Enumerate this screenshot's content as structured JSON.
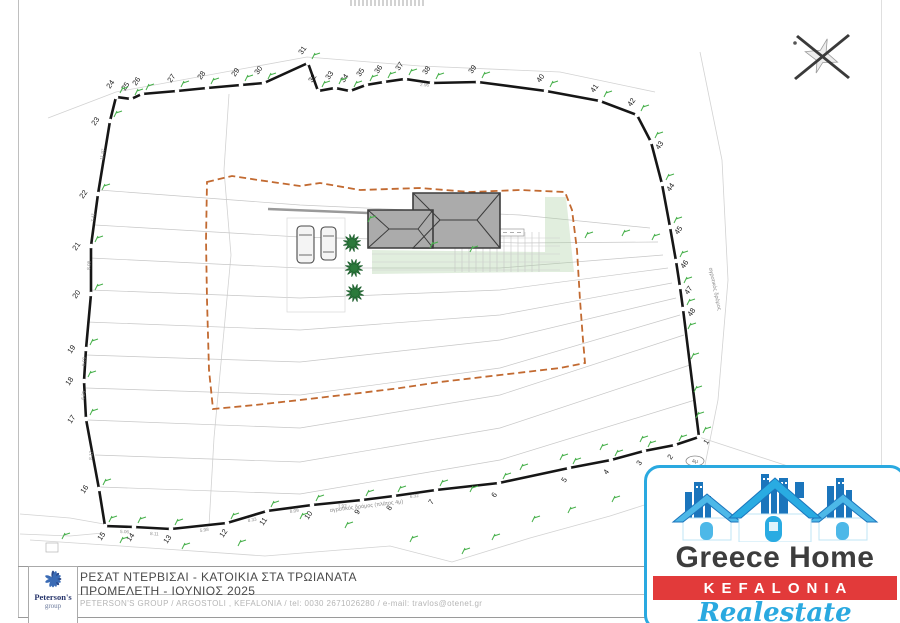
{
  "sheet": {
    "title_line1": "ΡΕΣΑΤ ΝΤΕΡΒΙΣΑΙ -  ΚΑΤΟΙΚΙΑ ΣΤΑ ΤΡΩΙΑΝΑΤΑ",
    "title_line2": "ΠΡΟΜΕΛΕΤΗ - ΙΟΥΝΙΟΣ  2025",
    "contact_line": "PETERSON'S GROUP / ARGOSTOLI , KEFALONIA / tel: 0030 2671026280 / e-mail: travlos@otenet.gr",
    "diagram_fragment": "ΔΙΑΓΡΑΜΜΑ"
  },
  "peterson_logo": {
    "name": "Peterson's",
    "sub": "group"
  },
  "greece_home_logo": {
    "line1": "Greece Home",
    "line2": "KEFALONIA",
    "line3": "Realestate",
    "accent_blue": "#2aa9e0",
    "band_red": "#e23a3a",
    "text_dark": "#3d3d3d"
  },
  "plan": {
    "colors": {
      "boundary": "#161616",
      "marker_green": "#47b04b",
      "setback_orange": "#c26a31",
      "roof_gray": "#ababab",
      "tree_green": "#2b7a3b",
      "contour_gray": "#c7c7c7"
    },
    "road_label_bottom": "αγροτικός δρόμος (πλάτος 4μ)",
    "road_label_right": "αγροτικός δρόμος",
    "oval_label": "4μ",
    "vertices": [
      {
        "n": "23",
        "x": 110,
        "y": 121,
        "side": "left"
      },
      {
        "n": "24",
        "x": 116,
        "y": 97,
        "side": "top"
      },
      {
        "n": "25",
        "x": 131,
        "y": 99,
        "side": "top"
      },
      {
        "n": "26",
        "x": 142,
        "y": 94,
        "side": "top"
      },
      {
        "n": "27",
        "x": 177,
        "y": 91,
        "side": "top"
      },
      {
        "n": "28",
        "x": 207,
        "y": 88,
        "side": "top"
      },
      {
        "n": "29",
        "x": 241,
        "y": 85,
        "side": "top"
      },
      {
        "n": "30",
        "x": 264,
        "y": 83,
        "side": "top"
      },
      {
        "n": "31",
        "x": 308,
        "y": 63,
        "side": "top"
      },
      {
        "n": "32",
        "x": 318,
        "y": 91,
        "side": "top"
      },
      {
        "n": "33",
        "x": 335,
        "y": 88,
        "side": "top"
      },
      {
        "n": "34",
        "x": 350,
        "y": 91,
        "side": "top"
      },
      {
        "n": "35",
        "x": 366,
        "y": 85,
        "side": "top"
      },
      {
        "n": "36",
        "x": 384,
        "y": 82,
        "side": "top"
      },
      {
        "n": "37",
        "x": 405,
        "y": 79,
        "side": "top"
      },
      {
        "n": "38",
        "x": 432,
        "y": 83,
        "side": "top"
      },
      {
        "n": "39",
        "x": 478,
        "y": 82,
        "side": "top"
      },
      {
        "n": "40",
        "x": 546,
        "y": 91,
        "side": "top"
      },
      {
        "n": "41",
        "x": 600,
        "y": 101,
        "side": "top"
      },
      {
        "n": "42",
        "x": 637,
        "y": 115,
        "side": "top"
      },
      {
        "n": "43",
        "x": 651,
        "y": 142,
        "side": "right"
      },
      {
        "n": "44",
        "x": 662,
        "y": 184,
        "side": "right"
      },
      {
        "n": "45",
        "x": 670,
        "y": 227,
        "side": "right"
      },
      {
        "n": "46",
        "x": 676,
        "y": 261,
        "side": "right"
      },
      {
        "n": "47",
        "x": 680,
        "y": 287,
        "side": "right"
      },
      {
        "n": "48",
        "x": 683,
        "y": 309,
        "side": "right"
      },
      {
        "n": "1",
        "x": 699,
        "y": 437,
        "side": "right"
      },
      {
        "n": "2",
        "x": 675,
        "y": 445,
        "side": "bottom"
      },
      {
        "n": "3",
        "x": 644,
        "y": 451,
        "side": "bottom"
      },
      {
        "n": "4",
        "x": 611,
        "y": 460,
        "side": "bottom"
      },
      {
        "n": "5",
        "x": 569,
        "y": 468,
        "side": "bottom"
      },
      {
        "n": "6",
        "x": 499,
        "y": 483,
        "side": "bottom"
      },
      {
        "n": "7",
        "x": 436,
        "y": 490,
        "side": "bottom"
      },
      {
        "n": "8",
        "x": 394,
        "y": 496,
        "side": "bottom"
      },
      {
        "n": "9",
        "x": 362,
        "y": 500,
        "side": "bottom"
      },
      {
        "n": "10",
        "x": 312,
        "y": 505,
        "side": "bottom"
      },
      {
        "n": "11",
        "x": 267,
        "y": 511,
        "side": "bottom"
      },
      {
        "n": "12",
        "x": 227,
        "y": 523,
        "side": "bottom"
      },
      {
        "n": "13",
        "x": 171,
        "y": 529,
        "side": "bottom"
      },
      {
        "n": "14",
        "x": 134,
        "y": 527,
        "side": "bottom"
      },
      {
        "n": "15",
        "x": 105,
        "y": 526,
        "side": "bottom"
      },
      {
        "n": "16",
        "x": 99,
        "y": 489,
        "side": "left"
      },
      {
        "n": "17",
        "x": 86,
        "y": 419,
        "side": "left"
      },
      {
        "n": "18",
        "x": 84,
        "y": 381,
        "side": "left"
      },
      {
        "n": "19",
        "x": 86,
        "y": 349,
        "side": "left"
      },
      {
        "n": "20",
        "x": 91,
        "y": 294,
        "side": "left"
      },
      {
        "n": "21",
        "x": 91,
        "y": 246,
        "side": "left"
      },
      {
        "n": "22",
        "x": 98,
        "y": 194,
        "side": "left"
      }
    ],
    "contours": [
      [
        [
          99,
          190
        ],
        [
          300,
          205
        ],
        [
          520,
          215
        ],
        [
          650,
          228
        ]
      ],
      [
        [
          95,
          225
        ],
        [
          300,
          237
        ],
        [
          520,
          243
        ],
        [
          658,
          242
        ]
      ],
      [
        [
          90,
          258
        ],
        [
          300,
          268
        ],
        [
          500,
          268
        ],
        [
          663,
          255
        ]
      ],
      [
        [
          90,
          290
        ],
        [
          300,
          298
        ],
        [
          500,
          290
        ],
        [
          668,
          268
        ]
      ],
      [
        [
          87,
          322
        ],
        [
          300,
          330
        ],
        [
          500,
          315
        ],
        [
          672,
          283
        ]
      ],
      [
        [
          86,
          355
        ],
        [
          300,
          362
        ],
        [
          500,
          340
        ],
        [
          676,
          298
        ]
      ],
      [
        [
          86,
          388
        ],
        [
          300,
          395
        ],
        [
          500,
          368
        ],
        [
          680,
          315
        ]
      ],
      [
        [
          88,
          420
        ],
        [
          300,
          428
        ],
        [
          500,
          395
        ],
        [
          684,
          335
        ]
      ],
      [
        [
          95,
          455
        ],
        [
          300,
          462
        ],
        [
          500,
          428
        ],
        [
          690,
          365
        ]
      ],
      [
        [
          100,
          487
        ],
        [
          300,
          494
        ],
        [
          500,
          460
        ],
        [
          695,
          400
        ]
      ]
    ],
    "faint_lines": [
      [
        [
          48,
          118
        ],
        [
          116,
          92
        ],
        [
          307,
          57
        ],
        [
          420,
          66
        ],
        [
          560,
          72
        ],
        [
          655,
          92
        ]
      ],
      [
        [
          700,
          52
        ],
        [
          722,
          160
        ],
        [
          728,
          280
        ],
        [
          718,
          400
        ],
        [
          704,
          470
        ]
      ],
      [
        [
          30,
          540
        ],
        [
          150,
          548
        ],
        [
          265,
          556
        ],
        [
          390,
          546
        ],
        [
          452,
          562
        ],
        [
          530,
          538
        ],
        [
          610,
          516
        ],
        [
          660,
          500
        ],
        [
          700,
          488
        ]
      ],
      [
        [
          20,
          514
        ],
        [
          70,
          518
        ],
        [
          104,
          524
        ]
      ],
      [
        [
          20,
          534
        ],
        [
          70,
          536
        ],
        [
          103,
          533
        ]
      ],
      [
        [
          229,
          94
        ],
        [
          224,
          170
        ],
        [
          231,
          255
        ],
        [
          222,
          352
        ],
        [
          214,
          438
        ],
        [
          209,
          526
        ]
      ],
      [
        [
          699,
          437
        ],
        [
          800,
          470
        ]
      ]
    ],
    "setback": [
      [
        207,
        182
      ],
      [
        232,
        176
      ],
      [
        258,
        180
      ],
      [
        300,
        186
      ],
      [
        320,
        183
      ],
      [
        360,
        190
      ],
      [
        420,
        188
      ],
      [
        470,
        192
      ],
      [
        520,
        190
      ],
      [
        565,
        192
      ],
      [
        572,
        210
      ],
      [
        577,
        250
      ],
      [
        580,
        300
      ],
      [
        583,
        340
      ],
      [
        585,
        363
      ],
      [
        560,
        368
      ],
      [
        500,
        375
      ],
      [
        440,
        382
      ],
      [
        400,
        388
      ],
      [
        360,
        393
      ],
      [
        300,
        400
      ],
      [
        255,
        405
      ],
      [
        213,
        409
      ],
      [
        209,
        370
      ],
      [
        207,
        300
      ],
      [
        206,
        240
      ]
    ],
    "green_areas": [
      [
        [
          545,
          197
        ],
        [
          566,
          197
        ],
        [
          574,
          272
        ],
        [
          545,
          272
        ]
      ],
      [
        [
          372,
          250
        ],
        [
          545,
          252
        ],
        [
          545,
          272
        ],
        [
          372,
          274
        ]
      ]
    ],
    "building": {
      "blocks": [
        [
          [
            413,
            193
          ],
          [
            500,
            193
          ],
          [
            500,
            248
          ],
          [
            413,
            248
          ]
        ],
        [
          [
            368,
            210
          ],
          [
            433,
            210
          ],
          [
            433,
            248
          ],
          [
            368,
            248
          ]
        ]
      ],
      "lines": [
        [
          500,
          193,
          477,
          220
        ],
        [
          500,
          248,
          477,
          220
        ],
        [
          477,
          220,
          440,
          220
        ],
        [
          413,
          193,
          440,
          220
        ],
        [
          413,
          248,
          440,
          220
        ],
        [
          368,
          210,
          389,
          229
        ],
        [
          368,
          248,
          389,
          229
        ],
        [
          389,
          229,
          418,
          229
        ],
        [
          433,
          248,
          418,
          229
        ],
        [
          433,
          210,
          418,
          229
        ]
      ]
    },
    "cars": [
      {
        "x": 297,
        "y": 226,
        "w": 17,
        "h": 37
      },
      {
        "x": 321,
        "y": 227,
        "w": 15,
        "h": 33
      }
    ],
    "trees": [
      {
        "x": 352,
        "y": 243,
        "r": 9
      },
      {
        "x": 354,
        "y": 268,
        "r": 9
      },
      {
        "x": 355,
        "y": 293,
        "r": 9
      }
    ],
    "driveway": [
      268,
      209,
      368,
      213
    ],
    "parking_rect": [
      287,
      218,
      58,
      94
    ],
    "note_box": [
      500,
      229,
      24,
      7
    ],
    "small_box": [
      46,
      543,
      12,
      9
    ],
    "oval": {
      "x": 695,
      "y": 461
    },
    "steps": {
      "vx1": 455,
      "vx2": 545,
      "vstep": 7,
      "vy1": 232,
      "vy2": 272,
      "hy1": 238,
      "hy2": 270,
      "hstep": 8,
      "hx1": 372,
      "hx2": 560
    },
    "green_marks": [
      [
        585,
        238
      ],
      [
        622,
        236
      ],
      [
        652,
        240
      ],
      [
        470,
        252
      ],
      [
        430,
        248
      ],
      [
        368,
        222
      ],
      [
        688,
        329
      ],
      [
        691,
        359
      ],
      [
        694,
        392
      ],
      [
        696,
        418
      ],
      [
        300,
        519
      ],
      [
        345,
        528
      ],
      [
        410,
        542
      ],
      [
        462,
        554
      ],
      [
        492,
        540
      ],
      [
        532,
        522
      ],
      [
        568,
        513
      ],
      [
        612,
        502
      ],
      [
        648,
        486
      ],
      [
        238,
        546
      ],
      [
        182,
        549
      ],
      [
        120,
        543
      ],
      [
        62,
        539
      ],
      [
        520,
        470
      ],
      [
        560,
        460
      ],
      [
        600,
        450
      ],
      [
        640,
        442
      ],
      [
        470,
        492
      ]
    ],
    "seg_labels": [
      {
        "t": "11.97",
        "x": 103,
        "y": 160,
        "r": -80
      },
      {
        "t": "7.41",
        "x": 94,
        "y": 222,
        "r": -85
      },
      {
        "t": "8.08",
        "x": 90,
        "y": 270,
        "r": -85
      },
      {
        "t": "5.09",
        "x": 85,
        "y": 366,
        "r": -85
      },
      {
        "t": "6.25",
        "x": 84,
        "y": 400,
        "r": -80
      },
      {
        "t": "8.17",
        "x": 92,
        "y": 460,
        "r": -85
      },
      {
        "t": "5.06",
        "x": 120,
        "y": 533,
        "r": 2
      },
      {
        "t": "8.11",
        "x": 150,
        "y": 535,
        "r": 3
      },
      {
        "t": "5.98",
        "x": 200,
        "y": 532,
        "r": -8
      },
      {
        "t": "8.33",
        "x": 248,
        "y": 522,
        "r": -10
      },
      {
        "t": "8.09",
        "x": 290,
        "y": 513,
        "r": -8
      },
      {
        "t": "7.92",
        "x": 338,
        "y": 508,
        "r": -6
      },
      {
        "t": "6.32",
        "x": 410,
        "y": 498,
        "r": -7
      },
      {
        "t": "2.96",
        "x": 420,
        "y": 86,
        "r": 4
      }
    ]
  }
}
